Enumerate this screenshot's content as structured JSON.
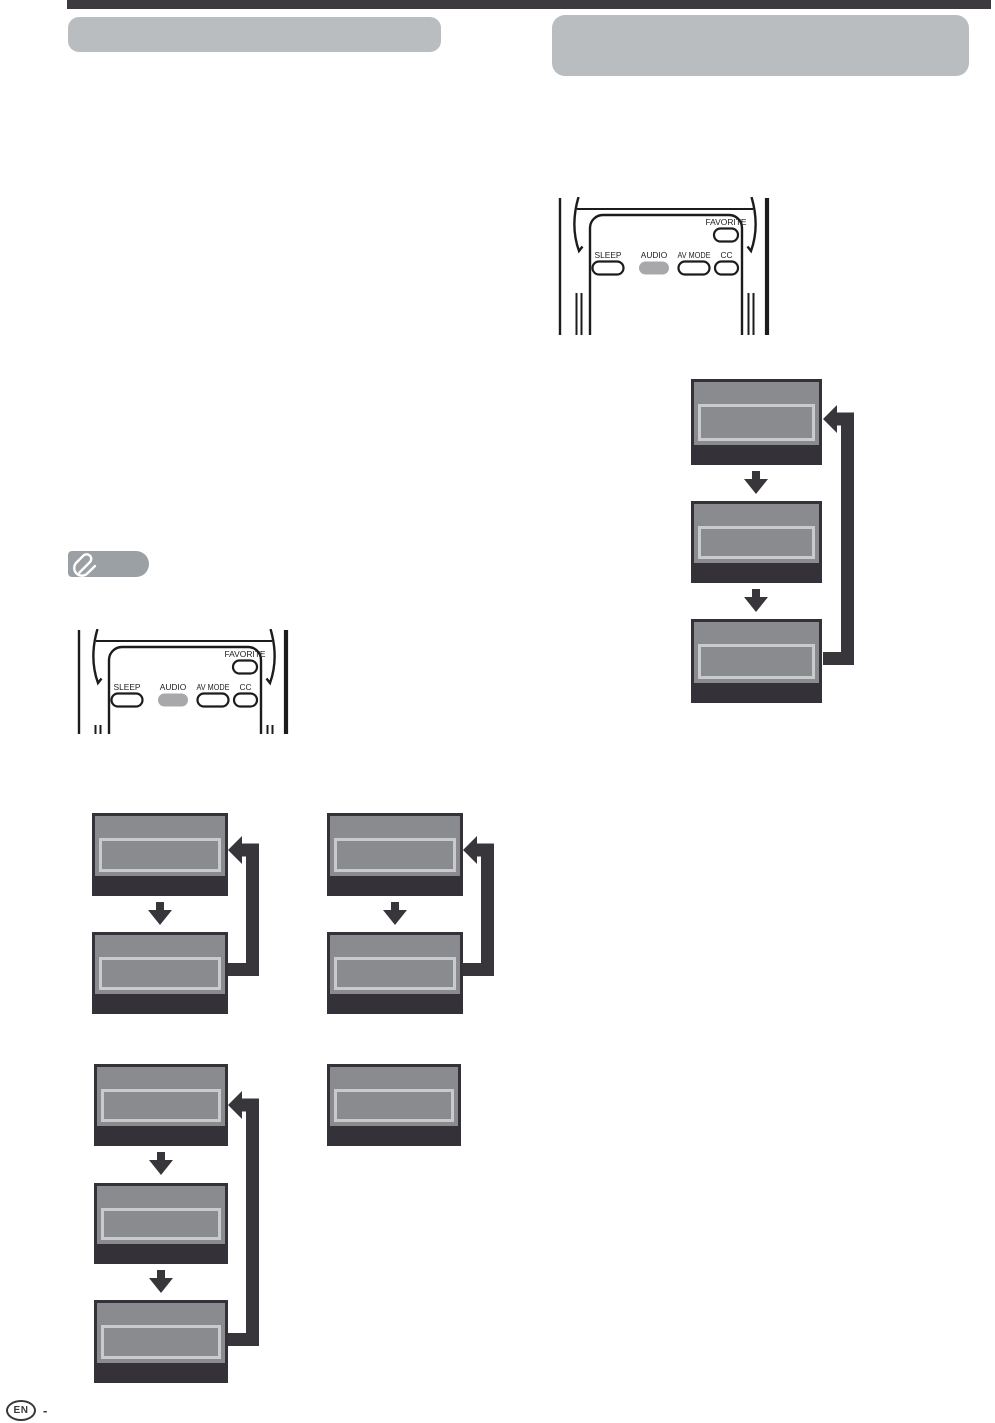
{
  "page": {
    "footer": {
      "language_badge": "EN",
      "separator": "-"
    }
  },
  "remote": {
    "favorite_label": "FAVORITE",
    "sleep_label": "SLEEP",
    "audio_label": "AUDIO",
    "av_mode_label": "AV MODE",
    "cc_label": "CC",
    "highlighted_button": "AUDIO"
  },
  "note_badge": {
    "icon": "paperclip-icon"
  },
  "cycle_diagrams": [
    {
      "location": "right-column",
      "steps": 3,
      "loop": true
    },
    {
      "location": "left-column-row1-left",
      "steps": 2,
      "loop": true
    },
    {
      "location": "left-column-row1-right",
      "steps": 2,
      "loop": true
    },
    {
      "location": "left-column-row2-left",
      "steps": 3,
      "loop": true
    },
    {
      "location": "left-column-row2-right",
      "steps": 1,
      "loop": false
    }
  ],
  "colors": {
    "top_rule": "#3c3a3e",
    "header_bar": "#b9bdc0",
    "note_badge": "#9aa0a4",
    "osd_box_body": "#8a8b8e",
    "osd_box_frame": "#343138",
    "osd_inner_outline": "#c9cacc",
    "arrow": "#39363b",
    "remote_outline": "#1c1c1c",
    "audio_button_fill": "#a8a8ab"
  }
}
